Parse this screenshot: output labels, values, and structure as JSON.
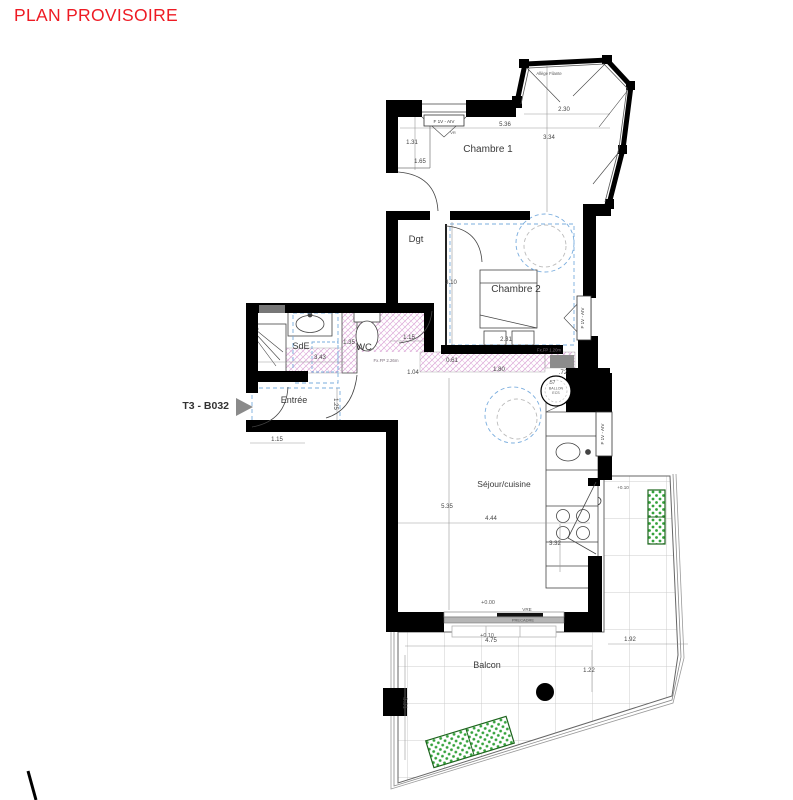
{
  "page_title": {
    "label": "PLAN PROVISOIRE"
  },
  "unit": {
    "label": "T3 - B032"
  },
  "colors": {
    "title_red": "#ee1b24",
    "dash_blue": "#7aadde",
    "hatch_pink": "#d9a0d6",
    "planter_green": "#35a23c",
    "wall_black": "#000000"
  },
  "rooms": [
    {
      "name": "chambre-1",
      "label": "Chambre 1",
      "x": 488,
      "y": 152,
      "size": 10
    },
    {
      "name": "dgt",
      "label": "Dgt",
      "x": 416,
      "y": 242,
      "size": 9.5
    },
    {
      "name": "chambre-2",
      "label": "Chambre 2",
      "x": 516,
      "y": 292,
      "size": 10
    },
    {
      "name": "sde",
      "label": "SdE",
      "x": 301,
      "y": 349,
      "size": 9
    },
    {
      "name": "wc",
      "label": "WC",
      "x": 364,
      "y": 350,
      "size": 9.5
    },
    {
      "name": "entree",
      "label": "Entrée",
      "x": 294,
      "y": 403,
      "size": 9
    },
    {
      "name": "sejour-cuisine",
      "label": "Séjour/cuisine",
      "x": 504,
      "y": 487,
      "size": 8.5
    },
    {
      "name": "balcon",
      "label": "Balcon",
      "x": 487,
      "y": 668,
      "size": 9
    }
  ],
  "window_labels": [
    {
      "name": "chambre1-window",
      "t": "F 1V - AIV",
      "x": 444,
      "y": 123
    },
    {
      "name": "chambre2-window",
      "t": "F 1V - AIV",
      "x": 584,
      "y": 318,
      "rot": -90
    },
    {
      "name": "cuisine-window",
      "t": "F 1V - AIV",
      "x": 604,
      "y": 434,
      "rot": -90
    }
  ],
  "annotations": [
    {
      "name": "allege",
      "t": "Allège Filante",
      "x": 549,
      "y": 75,
      "size": 4.2
    },
    {
      "name": "vr",
      "t": "VR",
      "x": 453,
      "y": 134,
      "size": 4
    },
    {
      "name": "ballon-1",
      "t": "BALLON",
      "x": 556,
      "y": 389.5,
      "size": 3.6
    },
    {
      "name": "ballon-2",
      "t": "ECS",
      "x": 556,
      "y": 394,
      "size": 3.6
    },
    {
      "name": "ballon-dim",
      "t": ".57",
      "x": 552,
      "y": 384,
      "size": 5
    },
    {
      "name": "vre",
      "t": "VRE",
      "x": 527,
      "y": 611,
      "size": 4.6
    },
    {
      "name": "precadre",
      "t": "PRECADRE",
      "x": 523,
      "y": 621.5,
      "size": 4
    },
    {
      "name": "level-0",
      "t": "+0.00",
      "x": 488,
      "y": 604,
      "size": 5.4
    },
    {
      "name": "level-10",
      "t": "+0.10",
      "x": 487,
      "y": 637,
      "size": 5.4
    },
    {
      "name": "level-10b",
      "t": "+0.10",
      "x": 623,
      "y": 489,
      "size": 4.6
    }
  ],
  "dimensions": [
    {
      "v": "2.30",
      "x": 564,
      "y": 111
    },
    {
      "v": "5.36",
      "x": 505,
      "y": 126
    },
    {
      "v": "3.34",
      "x": 549,
      "y": 139
    },
    {
      "v": "1.31",
      "x": 412,
      "y": 144
    },
    {
      "v": "1.65",
      "x": 420,
      "y": 163
    },
    {
      "v": "3.10",
      "x": 451,
      "y": 284
    },
    {
      "v": "2.31",
      "x": 506,
      "y": 341
    },
    {
      "v": "3.43",
      "x": 320,
      "y": 359
    },
    {
      "v": "1.35",
      "x": 349,
      "y": 344
    },
    {
      "v": "1.15",
      "x": 409,
      "y": 339
    },
    {
      "v": "1.25",
      "x": 334,
      "y": 404,
      "rot": 90
    },
    {
      "v": "0.61",
      "x": 452,
      "y": 362
    },
    {
      "v": "1.04",
      "x": 413,
      "y": 374
    },
    {
      "v": "1.80",
      "x": 499,
      "y": 371
    },
    {
      "v": ".72",
      "x": 563,
      "y": 374
    },
    {
      "v": "Fx.FP 2.26m",
      "x": 386,
      "y": 362,
      "size": 4.4,
      "color": "#7a6d7a"
    },
    {
      "v": "Fx.FP 1.20m",
      "x": 549,
      "y": 351.5,
      "size": 4.2,
      "color": "#7a6d7a"
    },
    {
      "v": "5.35",
      "x": 447,
      "y": 508
    },
    {
      "v": "4.44",
      "x": 491,
      "y": 520
    },
    {
      "v": "3.32",
      "x": 555,
      "y": 545
    },
    {
      "v": "4.75",
      "x": 491,
      "y": 642
    },
    {
      "v": "1.92",
      "x": 630,
      "y": 641
    },
    {
      "v": "1.22",
      "x": 589,
      "y": 672
    },
    {
      "v": "3.31",
      "x": 403,
      "y": 703,
      "rot": 90
    },
    {
      "v": "1.15",
      "x": 277,
      "y": 441
    }
  ]
}
